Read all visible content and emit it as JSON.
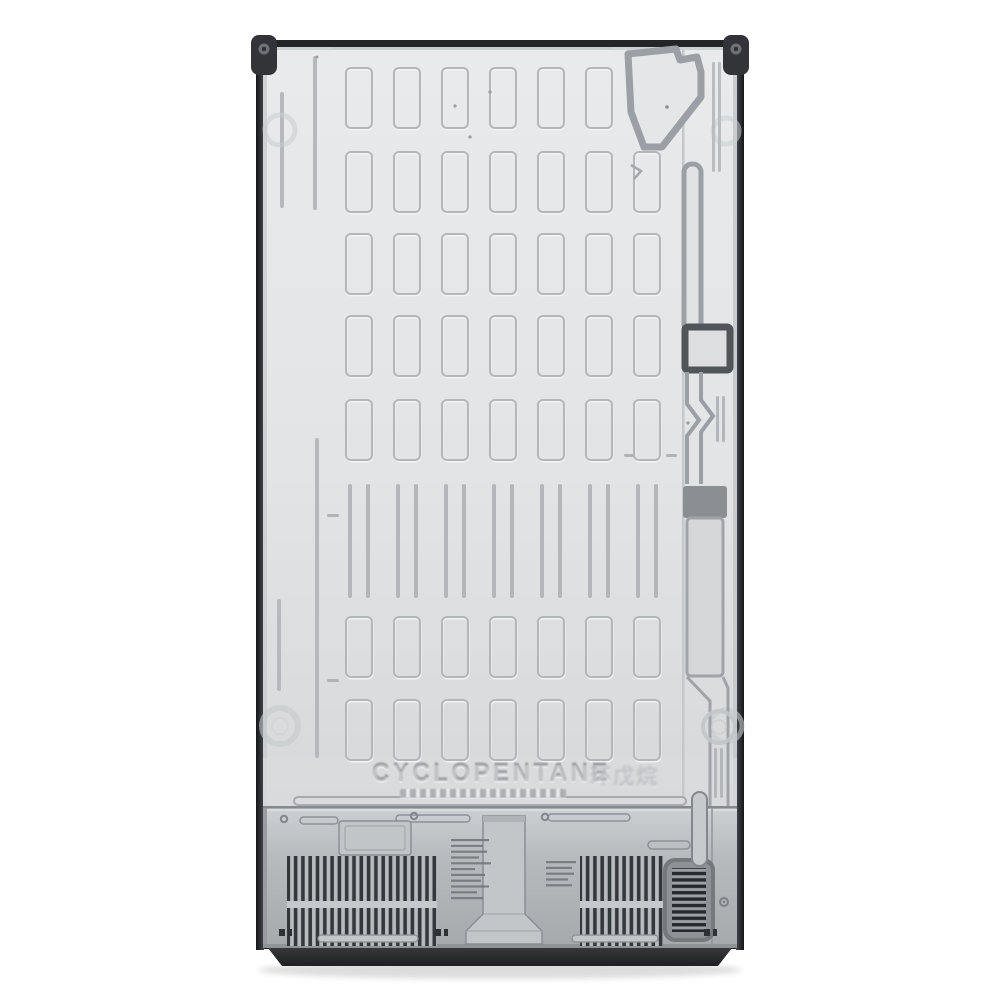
{
  "scene": {
    "description": "Rear view product photograph of a refrigerator back panel on a white background",
    "background_color": "#ffffff"
  },
  "emboss": {
    "main_text": "CYCLOPENTANE",
    "cjk_text": "环戊烷"
  },
  "colors": {
    "panel": "#e3e5e7",
    "panel_groove": "#b3b7bb",
    "channel_outline": "#9aa0a5",
    "square_cutout_border": "#515458",
    "frame": "#232527",
    "compressor_cover": "#b4b7ba",
    "vent_slat": "#34373b",
    "grille_slat": "#26292c",
    "base": "#2a2c2e"
  }
}
